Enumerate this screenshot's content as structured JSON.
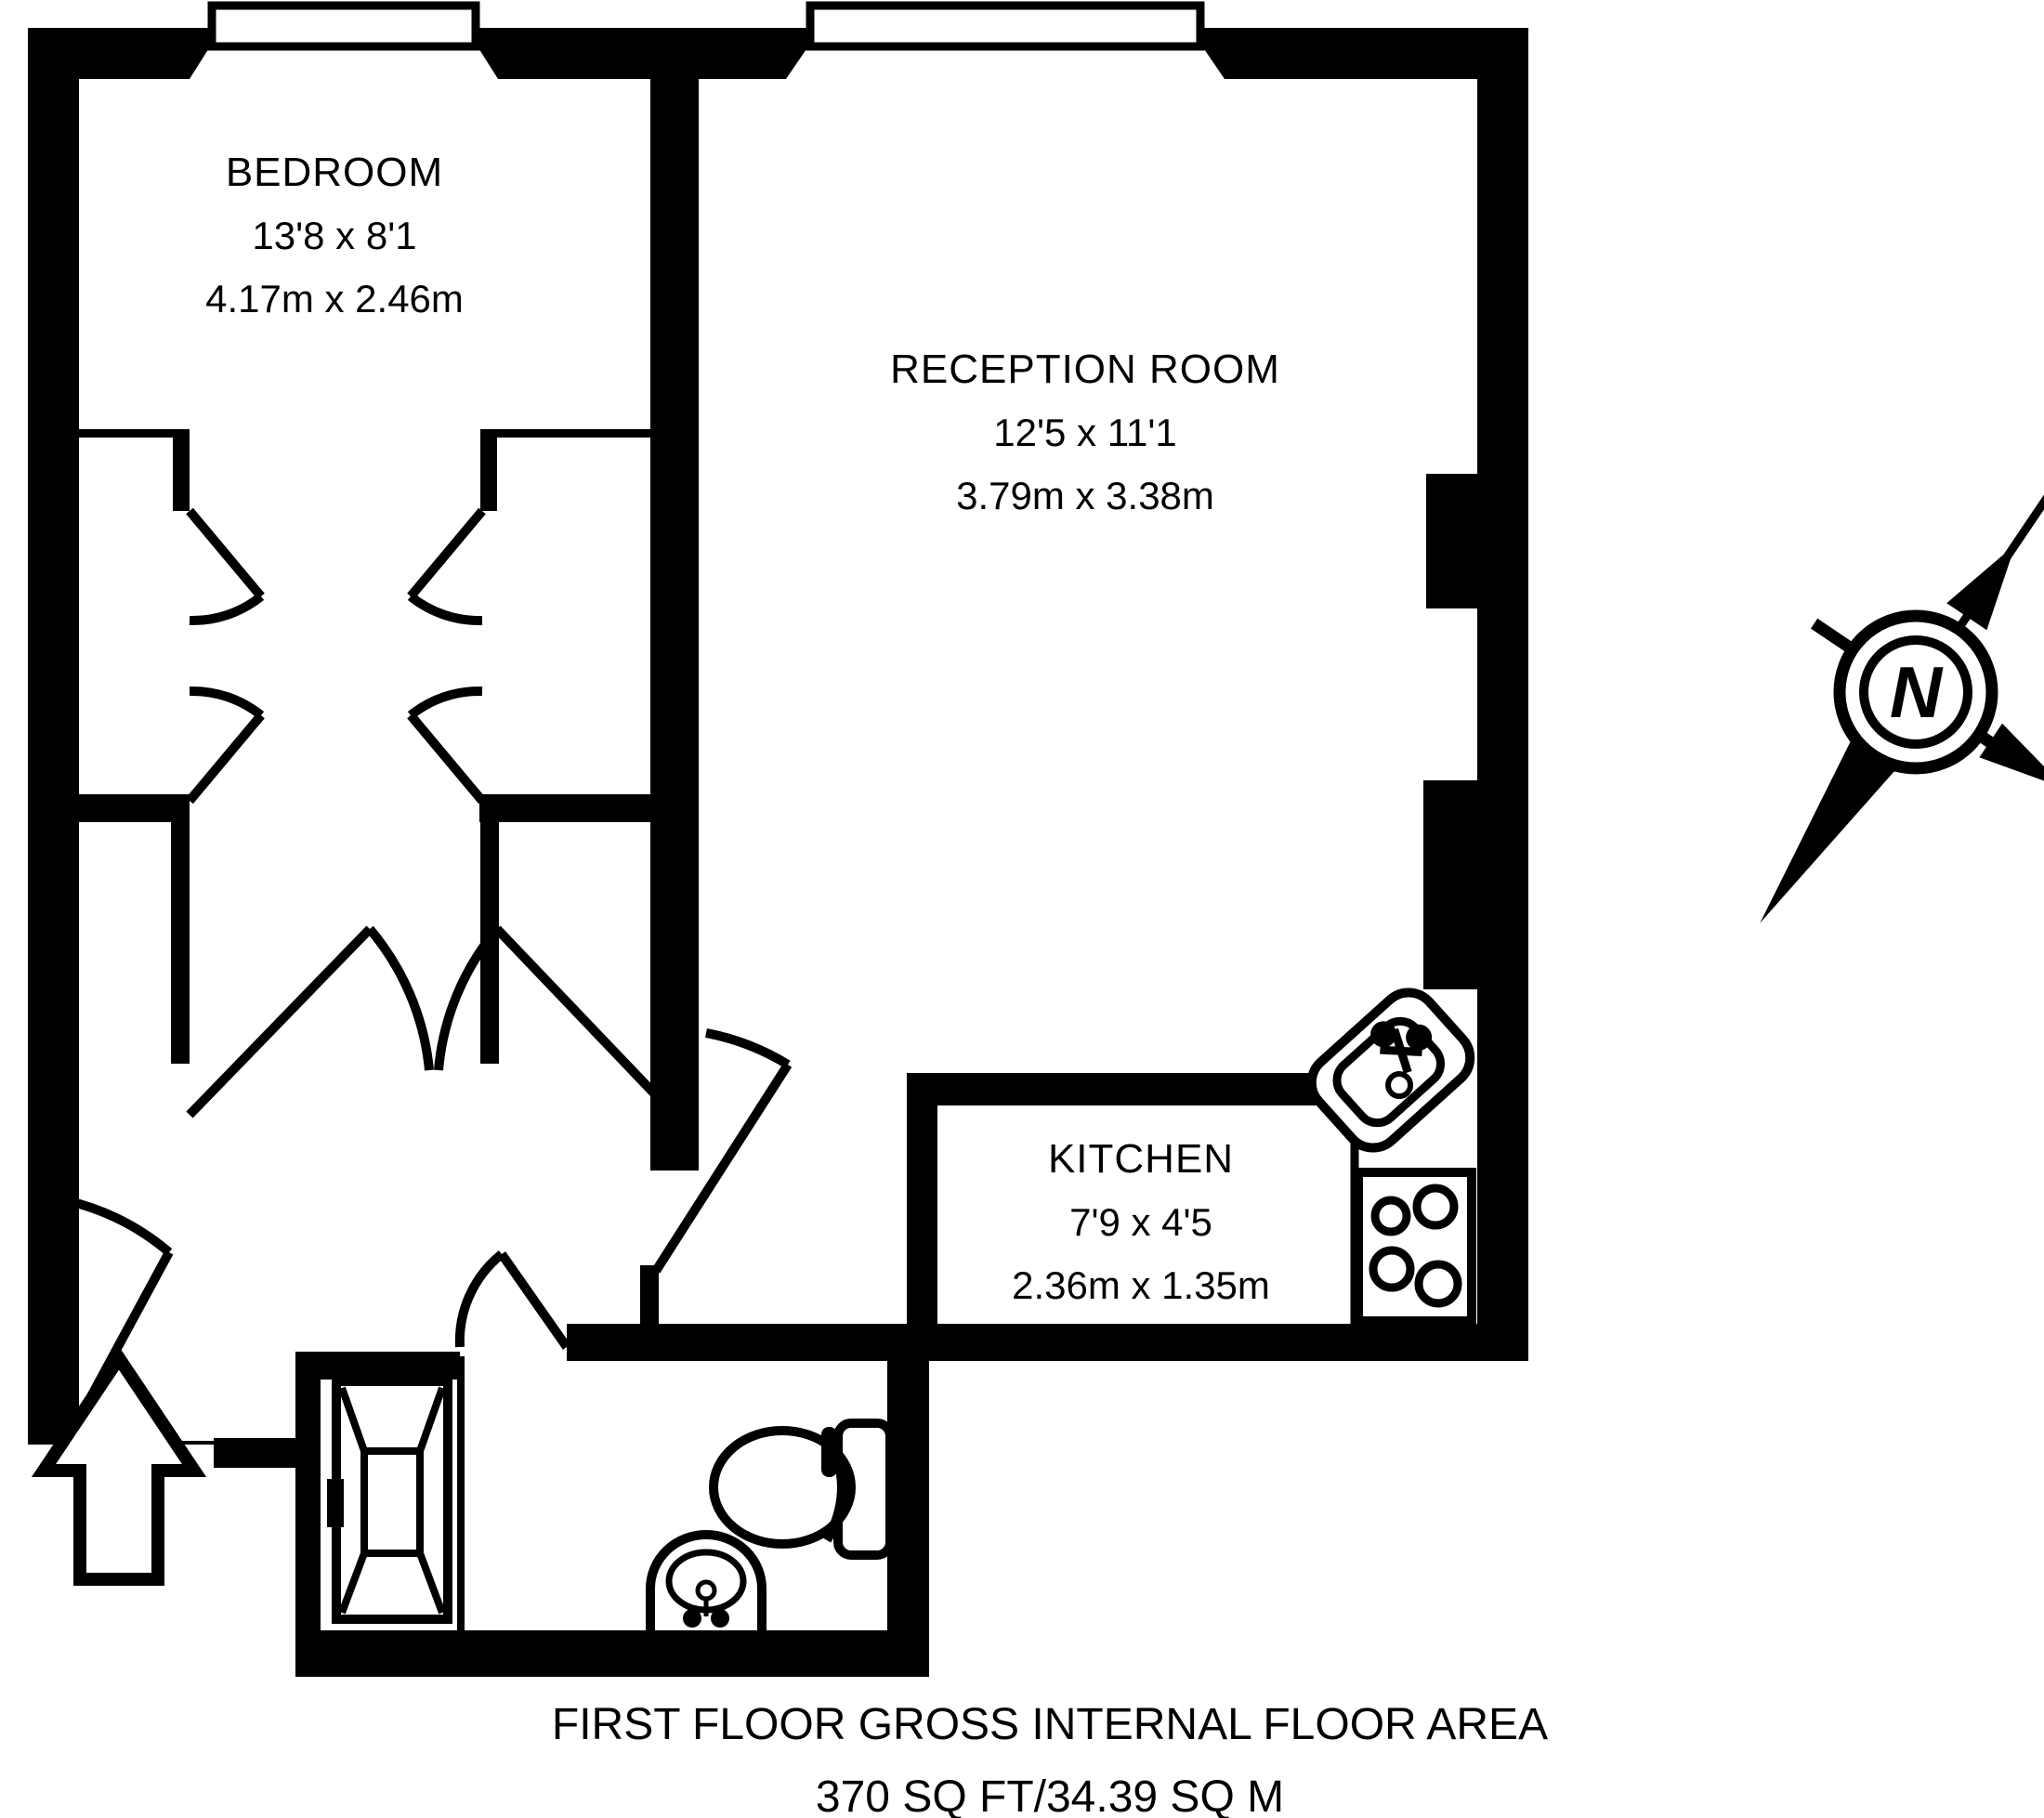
{
  "plan": {
    "floor_caption_line1": "FIRST FLOOR GROSS INTERNAL FLOOR AREA",
    "floor_caption_line2": "370 SQ FT/34.39 SQ M"
  },
  "rooms": [
    {
      "id": "bedroom",
      "name": "BEDROOM",
      "dims_imperial": "13'8 x 8'1",
      "dims_metric": "4.17m x 2.46m"
    },
    {
      "id": "reception",
      "name": "RECEPTION ROOM",
      "dims_imperial": "12'5 x 11'1",
      "dims_metric": "3.79m x 3.38m"
    },
    {
      "id": "kitchen",
      "name": "KITCHEN",
      "dims_imperial": "7'9 x 4'5",
      "dims_metric": "2.36m x 1.35m"
    }
  ],
  "compass": {
    "label": "N"
  },
  "fixtures": [
    "bathtub",
    "wash-basin",
    "toilet",
    "kitchen-sink",
    "hob",
    "entrance-arrow"
  ],
  "colors": {
    "ink": "#000000",
    "paper": "#ffffff"
  }
}
